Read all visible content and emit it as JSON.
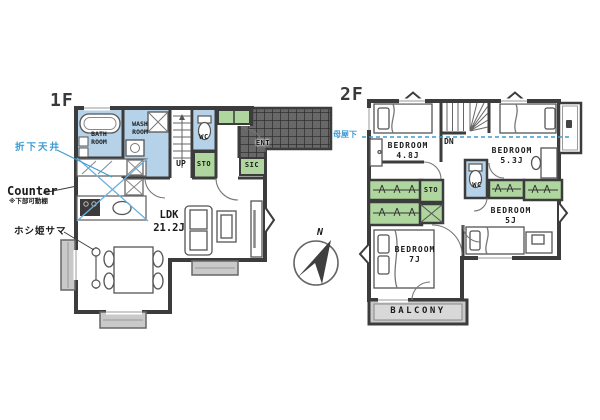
{
  "colors": {
    "wall": "#3c3c3c",
    "wet_room_fill": "#b5d2e8",
    "storage_fill": "#aed69e",
    "deck_fill": "#c9c9c9",
    "porch_tile": "#686868",
    "annotation_blue": "#3d9bd1"
  },
  "floor1": {
    "title": "1F",
    "labels": {
      "bath": "BATH\nROOM",
      "wash": "WASH\nROOM",
      "wc": "WC",
      "sto": "STO",
      "up": "UP",
      "sic": "SIC",
      "ent": "ENT",
      "ldk": "LDK\n21.2J"
    },
    "annotations": {
      "lowered_ceiling": "折下天井",
      "counter": "Counter",
      "counter_note": "※下部可動棚",
      "laundry_hanger": "ホシ姫サマ"
    }
  },
  "floor2": {
    "title": "2F",
    "labels": {
      "bedroom48": "BEDROOM\n4.8J",
      "bedroom53": "BEDROOM\n5.3J",
      "bedroom5": "BEDROOM\n5J",
      "bedroom7": "BEDROOM\n7J",
      "sto": "STO",
      "wc": "WC",
      "dn": "DN",
      "balcony": "BALCONY"
    },
    "annotations": {
      "roof_slope": "母屋下"
    }
  },
  "compass": {
    "north_label": "N"
  }
}
